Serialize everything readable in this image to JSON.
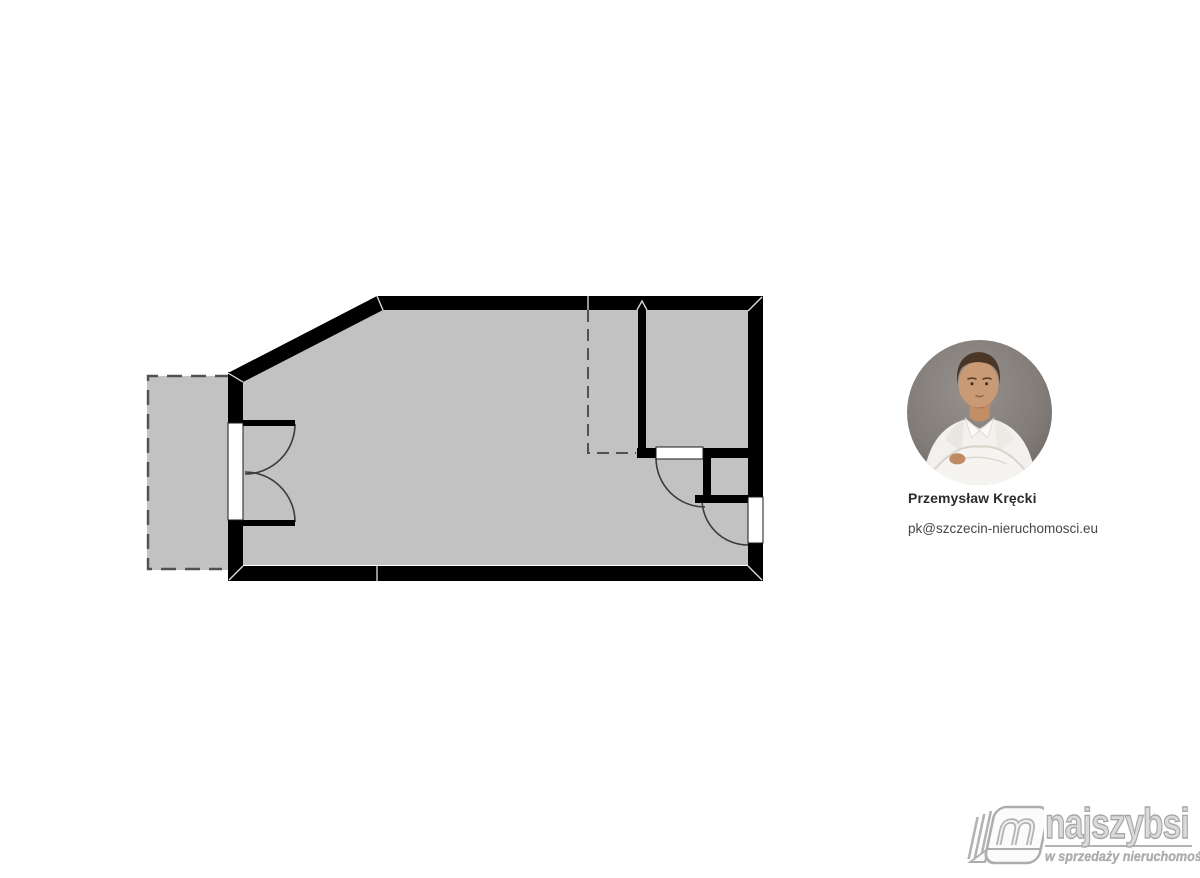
{
  "page": {
    "background": "#ffffff"
  },
  "floorplan": {
    "type": "apartment-floor-plan",
    "colors": {
      "wall": "#000000",
      "floor": "#c2c2c2",
      "dashed_line": "#515151",
      "door_arc": "#3c3c3c",
      "opening_outline": "#1a1a1a",
      "opening_fill": "#ffffff"
    },
    "features": [
      "balcony-terrace-dashed",
      "main-room",
      "small-room-top-right",
      "double-balcony-door",
      "interior-door",
      "entrance-door",
      "dashed-zone-marker"
    ]
  },
  "agent": {
    "photo": "agent-portrait-photo",
    "name": "Przemysław Kręcki",
    "email": "pk@szczecin-nieruchomosci.eu"
  },
  "logo": {
    "icon": "book-m-logo-icon",
    "brand": "najszybsi",
    "tagline": "w sprzedaży nieruchomości"
  }
}
